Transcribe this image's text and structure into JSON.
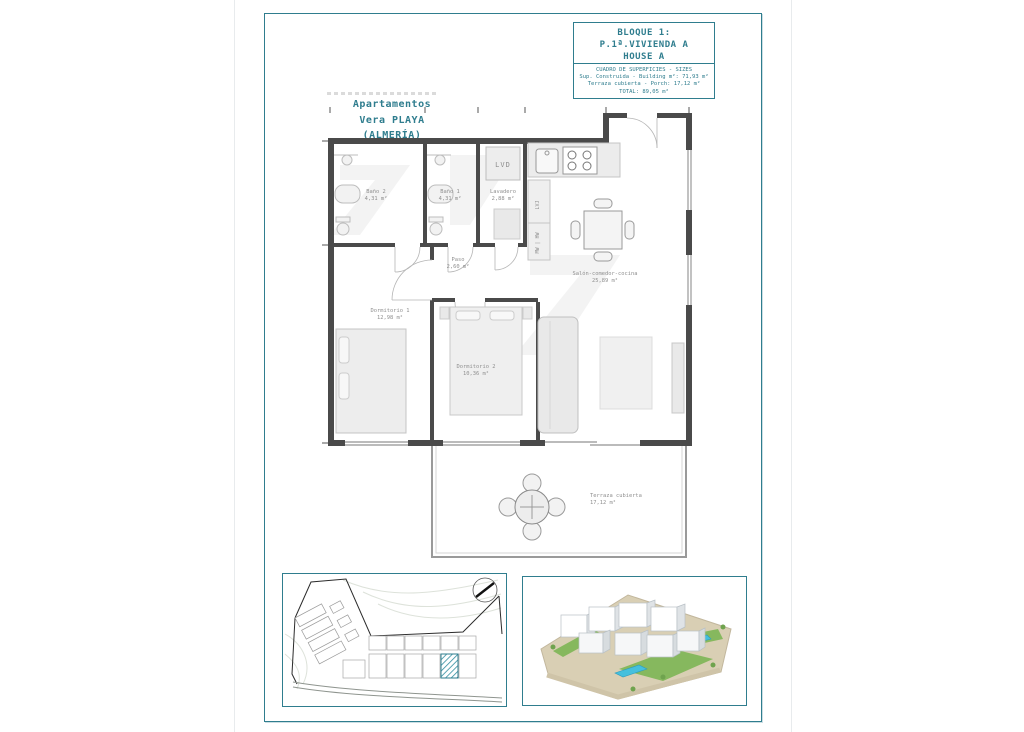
{
  "title_block": {
    "block_line": "BLOQUE 1:",
    "unit_line": "P.1ª.VIVIENDA A",
    "house_line": "HOUSE A",
    "table_header": "CUADRO DE SUPERFICIES - SIZES",
    "row_built": "Sup. Construida - Building m²: 71,93 m²",
    "row_porch": "Terraza cubierta - Porch: 17,12 m²",
    "row_total": "TOTAL: 89,05 m²"
  },
  "project_label": {
    "line1": "Apartamentos",
    "line2": "Vera PLAYA",
    "line3": "(ALMERÍA)"
  },
  "floor_plan": {
    "rooms": [
      {
        "name": "Baño 2",
        "area": "4,31 m²"
      },
      {
        "name": "Baño 1",
        "area": "4,31 m²"
      },
      {
        "name": "Lavadero",
        "area": "2,88 m²"
      },
      {
        "name": "Paso",
        "area": "2,60 m²"
      },
      {
        "name": "Dormitorio 1",
        "area": "12,98 m²"
      },
      {
        "name": "Dormitorio 2",
        "area": "10,36 m²"
      },
      {
        "name": "Salón-comedor-cocina",
        "area": "25,89 m²"
      },
      {
        "name": "Terraza cubierta",
        "area": "17,12 m²"
      }
    ],
    "appliance_labels": {
      "laundry": "LVD",
      "dishwasher": "LVJ",
      "oven_micro": "MW | HW"
    }
  },
  "colors": {
    "accent_teal": "#2f7d8e",
    "wall_dark": "#4a4a4a",
    "furniture_fill": "#e9e9e9",
    "label_gray": "#8f8f8f",
    "highlight_hatch": "#2f8da0",
    "pool_blue": "#45c0dd"
  }
}
